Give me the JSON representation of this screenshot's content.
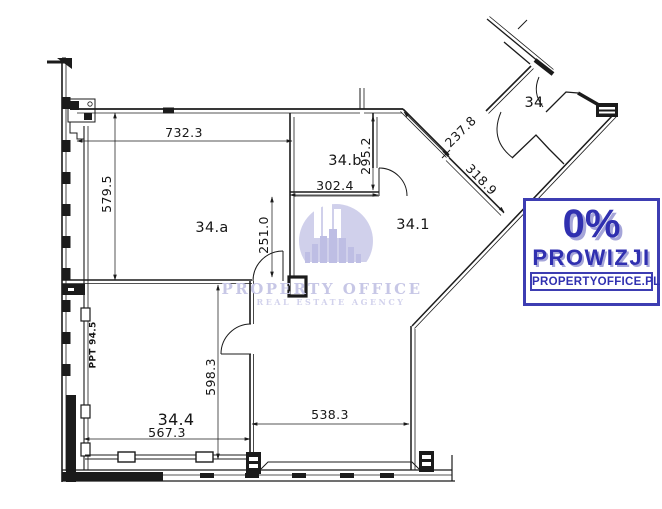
{
  "floor_plan": {
    "rooms": [
      "34.a",
      "34.b",
      "34.1",
      "34.4",
      "34"
    ],
    "dimensions": [
      "732.3",
      "579.5",
      "302.4",
      "295.2",
      "251.0",
      "237.8",
      "318.9",
      "598.3",
      "567.3",
      "538.3"
    ],
    "shaft_label": "PPT 94.5",
    "line_color": "#1b1b1b"
  },
  "watermark": {
    "name": "PROPERTY OFFICE",
    "tagline": "REAL ESTATE AGENCY",
    "circle_color": "#cdcdea"
  },
  "badge": {
    "percent": "0%",
    "line2": "PROWIZJI",
    "line3": "PROPERTYOFFICE.PL",
    "accent": "#3d3db2",
    "text_color": "#3030b0"
  }
}
